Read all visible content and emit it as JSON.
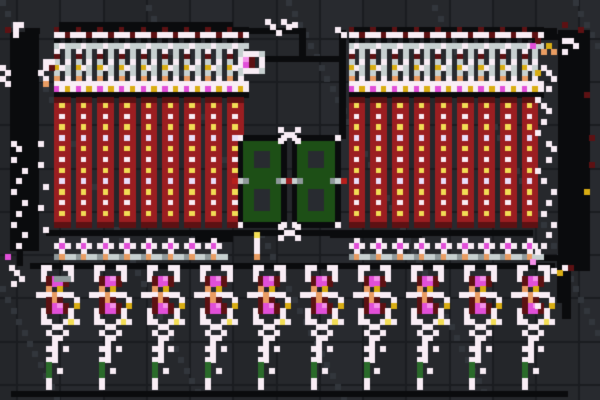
{
  "canvas": {
    "width": 600,
    "height": 400,
    "art_width": 111,
    "art_height": 74
  },
  "background": {
    "shades": [
      "#26282c",
      "#24262a",
      "#282a2f"
    ],
    "grout": "#1a1c20",
    "noise": "#32363c",
    "tile": 8,
    "offset_x": 3,
    "offset_y": 7
  },
  "palette": {
    "k": "#0a0b0d",
    "e": "#17181b",
    "w": "#f9edf5",
    "u": "#e9defa",
    "g": "#c7d0d0",
    "G": "#8e989a",
    "r": "#9b1e21",
    "q": "#5d1113",
    "R": "#b71f1c",
    "y": "#d9ad13",
    "Y": "#f2dd55",
    "o": "#e99c62",
    "m": "#e14fd8",
    "M": "#f590ea",
    "v": "#1d4f16",
    "c": "#282b30",
    "n": "#2a6b2a"
  },
  "display_value": "88",
  "display_color": "#1d4f16",
  "sprites": {
    "top_unit": [
      "qkkk",
      "wwqw",
      "k.k.",
      "gwgg",
      "w.g.",
      "q.g.",
      "g.w.",
      "ywg.",
      "g.g.",
      "o.w.",
      "wwww",
      "mwyw",
      "kkkk"
    ],
    "red_column": [
      "qqq",
      "rYr",
      "rrr",
      "rwr",
      "rrr",
      "rYr",
      "rrr",
      "rur",
      "rrr",
      "rYr",
      "rrr",
      "rwr",
      "rrr",
      "rYr",
      "rrr",
      "rur",
      "rrr",
      "rYr",
      "rrr",
      "rwr",
      "rrr",
      "rYr",
      "rrr",
      "qqq"
    ],
    "cross_unit": [
      ".w..",
      "wmw.",
      ".w..",
      "Gogg"
    ],
    "display": [
      "wkkkkkkkw",
      "kvvvvvvvk",
      "kvvvvvvvk",
      "kvvcccvvk",
      "kvvcccvvk",
      "kvvcccvvk",
      "kvvvvvvvk",
      "kvvvvvvvk",
      "gGvvvvvGg",
      "kvvvvvvvk",
      "kvvcccvvk",
      "kvvcccvvk",
      "kvvcccvvk",
      "kvvcccvvk",
      "kvvvvvvvk",
      "kvvvvvvvk",
      "wkkkkkkkw"
    ],
    "xmark": [
      "w..w",
      ".ww.",
      "w..w"
    ],
    "center_comp": [
      "gwwwg",
      "wMq.w",
      "wmq.w",
      "gwwwg"
    ],
    "center_torch": [
      ".Y.",
      ".w.",
      ".w.",
      ".w.",
      ".o."
    ],
    "bottom_unit": [
      ".ww..ww.",
      ".w....w.",
      ".wqmMqw.",
      "..qmmq..",
      "..o.y...",
      "wwwowww.",
      "..qoq..w",
      "..qmMq.y",
      ".wqmmqw.",
      ".w....w.",
      ".ww..wYw",
      "...ww...",
      "..w..w..",
      "...ww...",
      "...w....",
      "..ww.w..",
      "...w....",
      "..ww....",
      "..n.....",
      "..n.w...",
      "..n.....",
      "..w.....",
      "..w....."
    ]
  },
  "stamps": [
    {
      "sprite": "top_unit",
      "x": 10,
      "y": 5,
      "count": 9,
      "dx": 4
    },
    {
      "sprite": "top_unit",
      "x": 64.5,
      "y": 5,
      "count": 9,
      "dx": 4
    },
    {
      "sprite": "red_column",
      "x": 10,
      "y": 18,
      "count": 9,
      "dx": 4
    },
    {
      "sprite": "red_column",
      "x": 64.5,
      "y": 18,
      "count": 9,
      "dx": 4
    },
    {
      "sprite": "cross_unit",
      "x": 10,
      "y": 44,
      "count": 8,
      "dx": 4
    },
    {
      "sprite": "cross_unit",
      "x": 64.5,
      "y": 44,
      "count": 9,
      "dx": 4
    },
    {
      "sprite": "display",
      "x": 44,
      "y": 25,
      "count": 1,
      "dx": 0
    },
    {
      "sprite": "display",
      "x": 54,
      "y": 25,
      "count": 1,
      "dx": 0
    },
    {
      "sprite": "xmark",
      "x": 51.5,
      "y": 23.5,
      "count": 1,
      "dx": 0
    },
    {
      "sprite": "xmark",
      "x": 51.5,
      "y": 41.5,
      "count": 1,
      "dx": 0
    },
    {
      "sprite": "center_comp",
      "x": 44,
      "y": 9.5,
      "count": 1,
      "dx": 0
    },
    {
      "sprite": "center_torch",
      "x": 46,
      "y": 43,
      "count": 1,
      "dx": 0
    },
    {
      "sprite": "bottom_unit",
      "x": 6.6,
      "y": 49,
      "count": 10,
      "dx": 9.78
    }
  ],
  "rects": [
    [
      1.8,
      6,
      5.2,
      40.5,
      "k"
    ],
    [
      103.3,
      5.6,
      5.8,
      44.5,
      "k"
    ],
    [
      11,
      4,
      32,
      1.2,
      "k"
    ],
    [
      42,
      4,
      1,
      2,
      "k"
    ],
    [
      42,
      5.2,
      14,
      1,
      "k"
    ],
    [
      55.3,
      5.2,
      1.2,
      5.5,
      "k"
    ],
    [
      48,
      10.4,
      15.5,
      1,
      "k"
    ],
    [
      62.8,
      5.6,
      1.2,
      20,
      "k"
    ],
    [
      42,
      5.2,
      1,
      20,
      "k"
    ],
    [
      65,
      5.2,
      38,
      1.2,
      "k"
    ],
    [
      4.6,
      5.2,
      2.6,
      1,
      "k"
    ],
    [
      4.6,
      5.2,
      1,
      2.5,
      "k"
    ],
    [
      36,
      43.6,
      7,
      1,
      "k"
    ],
    [
      61,
      43,
      17,
      1,
      "k"
    ],
    [
      8.5,
      42.6,
      90,
      1,
      "k"
    ],
    [
      5.5,
      48.6,
      97,
      1,
      "k"
    ],
    [
      2,
      72.4,
      103,
      1,
      "k"
    ],
    [
      3.2,
      46,
      1,
      3,
      "k"
    ],
    [
      104,
      50,
      1.5,
      9,
      "k"
    ],
    [
      97,
      6.2,
      6.5,
      1,
      "k"
    ],
    [
      99.5,
      47.2,
      4.5,
      1,
      "k"
    ],
    [
      103,
      48,
      1,
      8,
      "k"
    ]
  ],
  "dots": [
    [
      0,
      12,
      "w"
    ],
    [
      1,
      13,
      "w"
    ],
    [
      0,
      14,
      "w"
    ],
    [
      1,
      15,
      "w"
    ],
    [
      7,
      13,
      "w"
    ],
    [
      8,
      14,
      "w"
    ],
    [
      8,
      11,
      "w"
    ],
    [
      9,
      11,
      "w"
    ],
    [
      8,
      12,
      "w"
    ],
    [
      2.4,
      4,
      "w"
    ],
    [
      3.4,
      4,
      "w"
    ],
    [
      2.4,
      5,
      "w"
    ],
    [
      2.4,
      6,
      "w"
    ],
    [
      2,
      26,
      "w"
    ],
    [
      3,
      27,
      "w"
    ],
    [
      2,
      29,
      "w"
    ],
    [
      4,
      31,
      "w"
    ],
    [
      3,
      33,
      "w"
    ],
    [
      2,
      35,
      "w"
    ],
    [
      4,
      37,
      "w"
    ],
    [
      3,
      39,
      "w"
    ],
    [
      2,
      41,
      "w"
    ],
    [
      4,
      43,
      "w"
    ],
    [
      3,
      45,
      "w"
    ],
    [
      7,
      26,
      "w"
    ],
    [
      7,
      30,
      "w"
    ],
    [
      8,
      34,
      "w"
    ],
    [
      7,
      38,
      "w"
    ],
    [
      8,
      42,
      "w"
    ],
    [
      100,
      12,
      "w"
    ],
    [
      101,
      13,
      "w"
    ],
    [
      102,
      14,
      "w"
    ],
    [
      101,
      16,
      "w"
    ],
    [
      99,
      18,
      "w"
    ],
    [
      100,
      19,
      "w"
    ],
    [
      101,
      20,
      "w"
    ],
    [
      100,
      22,
      "w"
    ],
    [
      99,
      24,
      "w"
    ],
    [
      101,
      26,
      "w"
    ],
    [
      102,
      27,
      "w"
    ],
    [
      101,
      29,
      "w"
    ],
    [
      99,
      31,
      "w"
    ],
    [
      100,
      33,
      "w"
    ],
    [
      102,
      35,
      "w"
    ],
    [
      101,
      37,
      "w"
    ],
    [
      100,
      39,
      "w"
    ],
    [
      102,
      41,
      "w"
    ],
    [
      101,
      43,
      "w"
    ],
    [
      100,
      45,
      "w"
    ],
    [
      99,
      46,
      "w"
    ],
    [
      1.7,
      49,
      "w"
    ],
    [
      2.5,
      50,
      "w"
    ],
    [
      3.5,
      51,
      "w"
    ],
    [
      2,
      52,
      "w"
    ],
    [
      100.5,
      49,
      "w"
    ],
    [
      102,
      49.5,
      "w"
    ],
    [
      104,
      49,
      "w"
    ],
    [
      99,
      56,
      "w"
    ],
    [
      49,
      3.5,
      "w"
    ],
    [
      50,
      4.5,
      "w"
    ],
    [
      52,
      3.5,
      "w"
    ],
    [
      53,
      4.5,
      "w"
    ],
    [
      51,
      5.5,
      "w"
    ],
    [
      54,
      4,
      "w"
    ],
    [
      104,
      7,
      "w"
    ],
    [
      105,
      7,
      "w"
    ],
    [
      106,
      8,
      "w"
    ],
    [
      104,
      9,
      "w"
    ],
    [
      62,
      5,
      "w"
    ],
    [
      63,
      6,
      "w"
    ],
    [
      1,
      5,
      "q"
    ],
    [
      9,
      12,
      "q"
    ],
    [
      99,
      7,
      "q"
    ],
    [
      108,
      17,
      "q"
    ],
    [
      109,
      25,
      "q"
    ],
    [
      109,
      30,
      "q"
    ],
    [
      105,
      49,
      "q"
    ],
    [
      104,
      4,
      "q"
    ],
    [
      107,
      5,
      "q"
    ],
    [
      43,
      33,
      "R"
    ],
    [
      63,
      33,
      "R"
    ],
    [
      53,
      33,
      "r"
    ],
    [
      99,
      13,
      "y"
    ],
    [
      108,
      35,
      "y"
    ],
    [
      101,
      8,
      "y"
    ],
    [
      103,
      50,
      "y"
    ],
    [
      98,
      8,
      "m"
    ],
    [
      1,
      47,
      "m"
    ],
    [
      98,
      48,
      "M"
    ],
    [
      100,
      9,
      "o"
    ],
    [
      8,
      15,
      "o"
    ],
    [
      102,
      9,
      "o"
    ],
    [
      10,
      51,
      "G"
    ],
    [
      11,
      51,
      "G"
    ],
    [
      12,
      51,
      "G"
    ]
  ]
}
